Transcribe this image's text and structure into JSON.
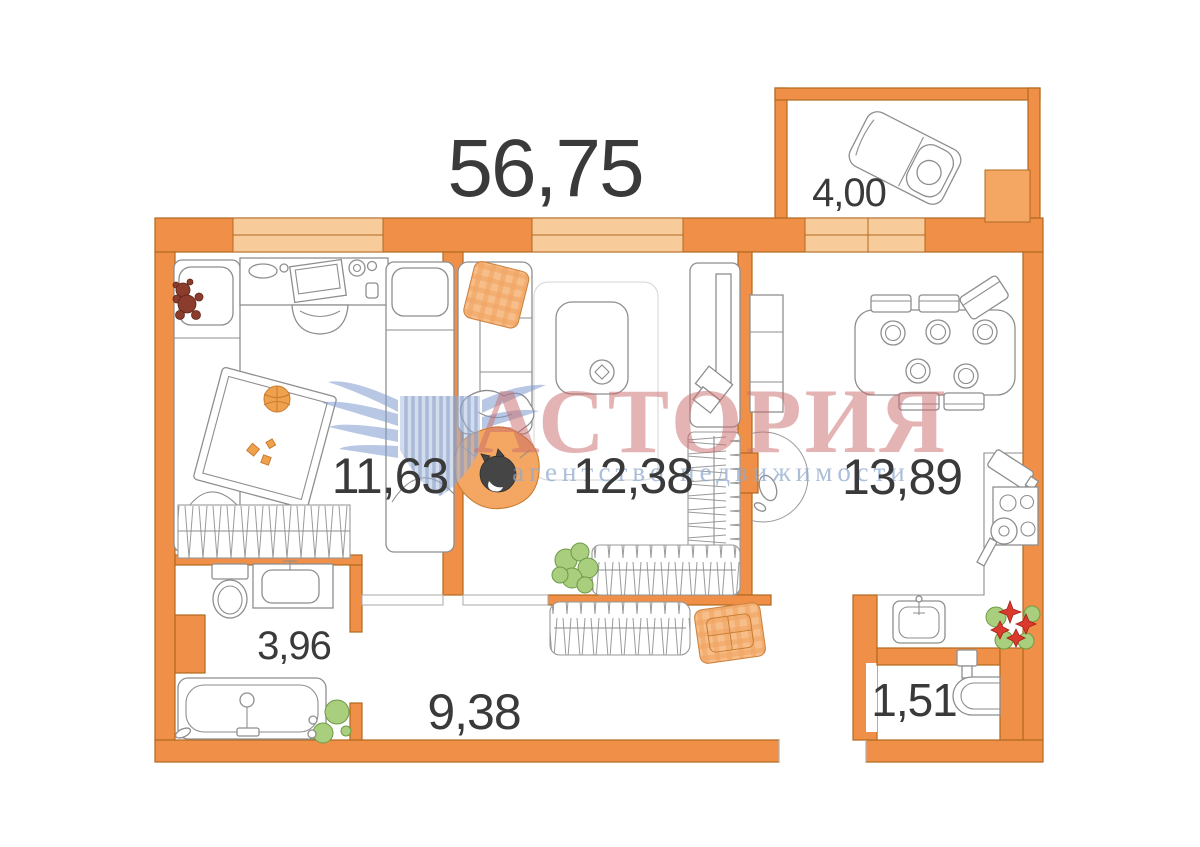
{
  "title": {
    "total_area": "56,75"
  },
  "watermark": {
    "brand": "АСТОРИЯ",
    "tagline": "агентство недвижимости",
    "brand_color": "#C96A6A",
    "tagline_color": "#8FA9CE",
    "logo": "winged-shield"
  },
  "rooms": {
    "bedroom": {
      "area": "11,63"
    },
    "living": {
      "area": "12,38"
    },
    "kitchen": {
      "area": "13,89"
    },
    "balcony": {
      "area": "4,00"
    },
    "bathroom": {
      "area": "3,96"
    },
    "hallway": {
      "area": "9,38"
    },
    "wc": {
      "area": "1,51"
    }
  },
  "colors": {
    "wall": "#F09048",
    "wall_outline": "#B2691F",
    "window": "#F8CB9B",
    "furniture_outline": "#8E8E8E",
    "label": "#3A3A3A",
    "plant_green": "#A9CE7D",
    "plant_red": "#DA3A2E",
    "fabric_orange": "#F3A763"
  }
}
